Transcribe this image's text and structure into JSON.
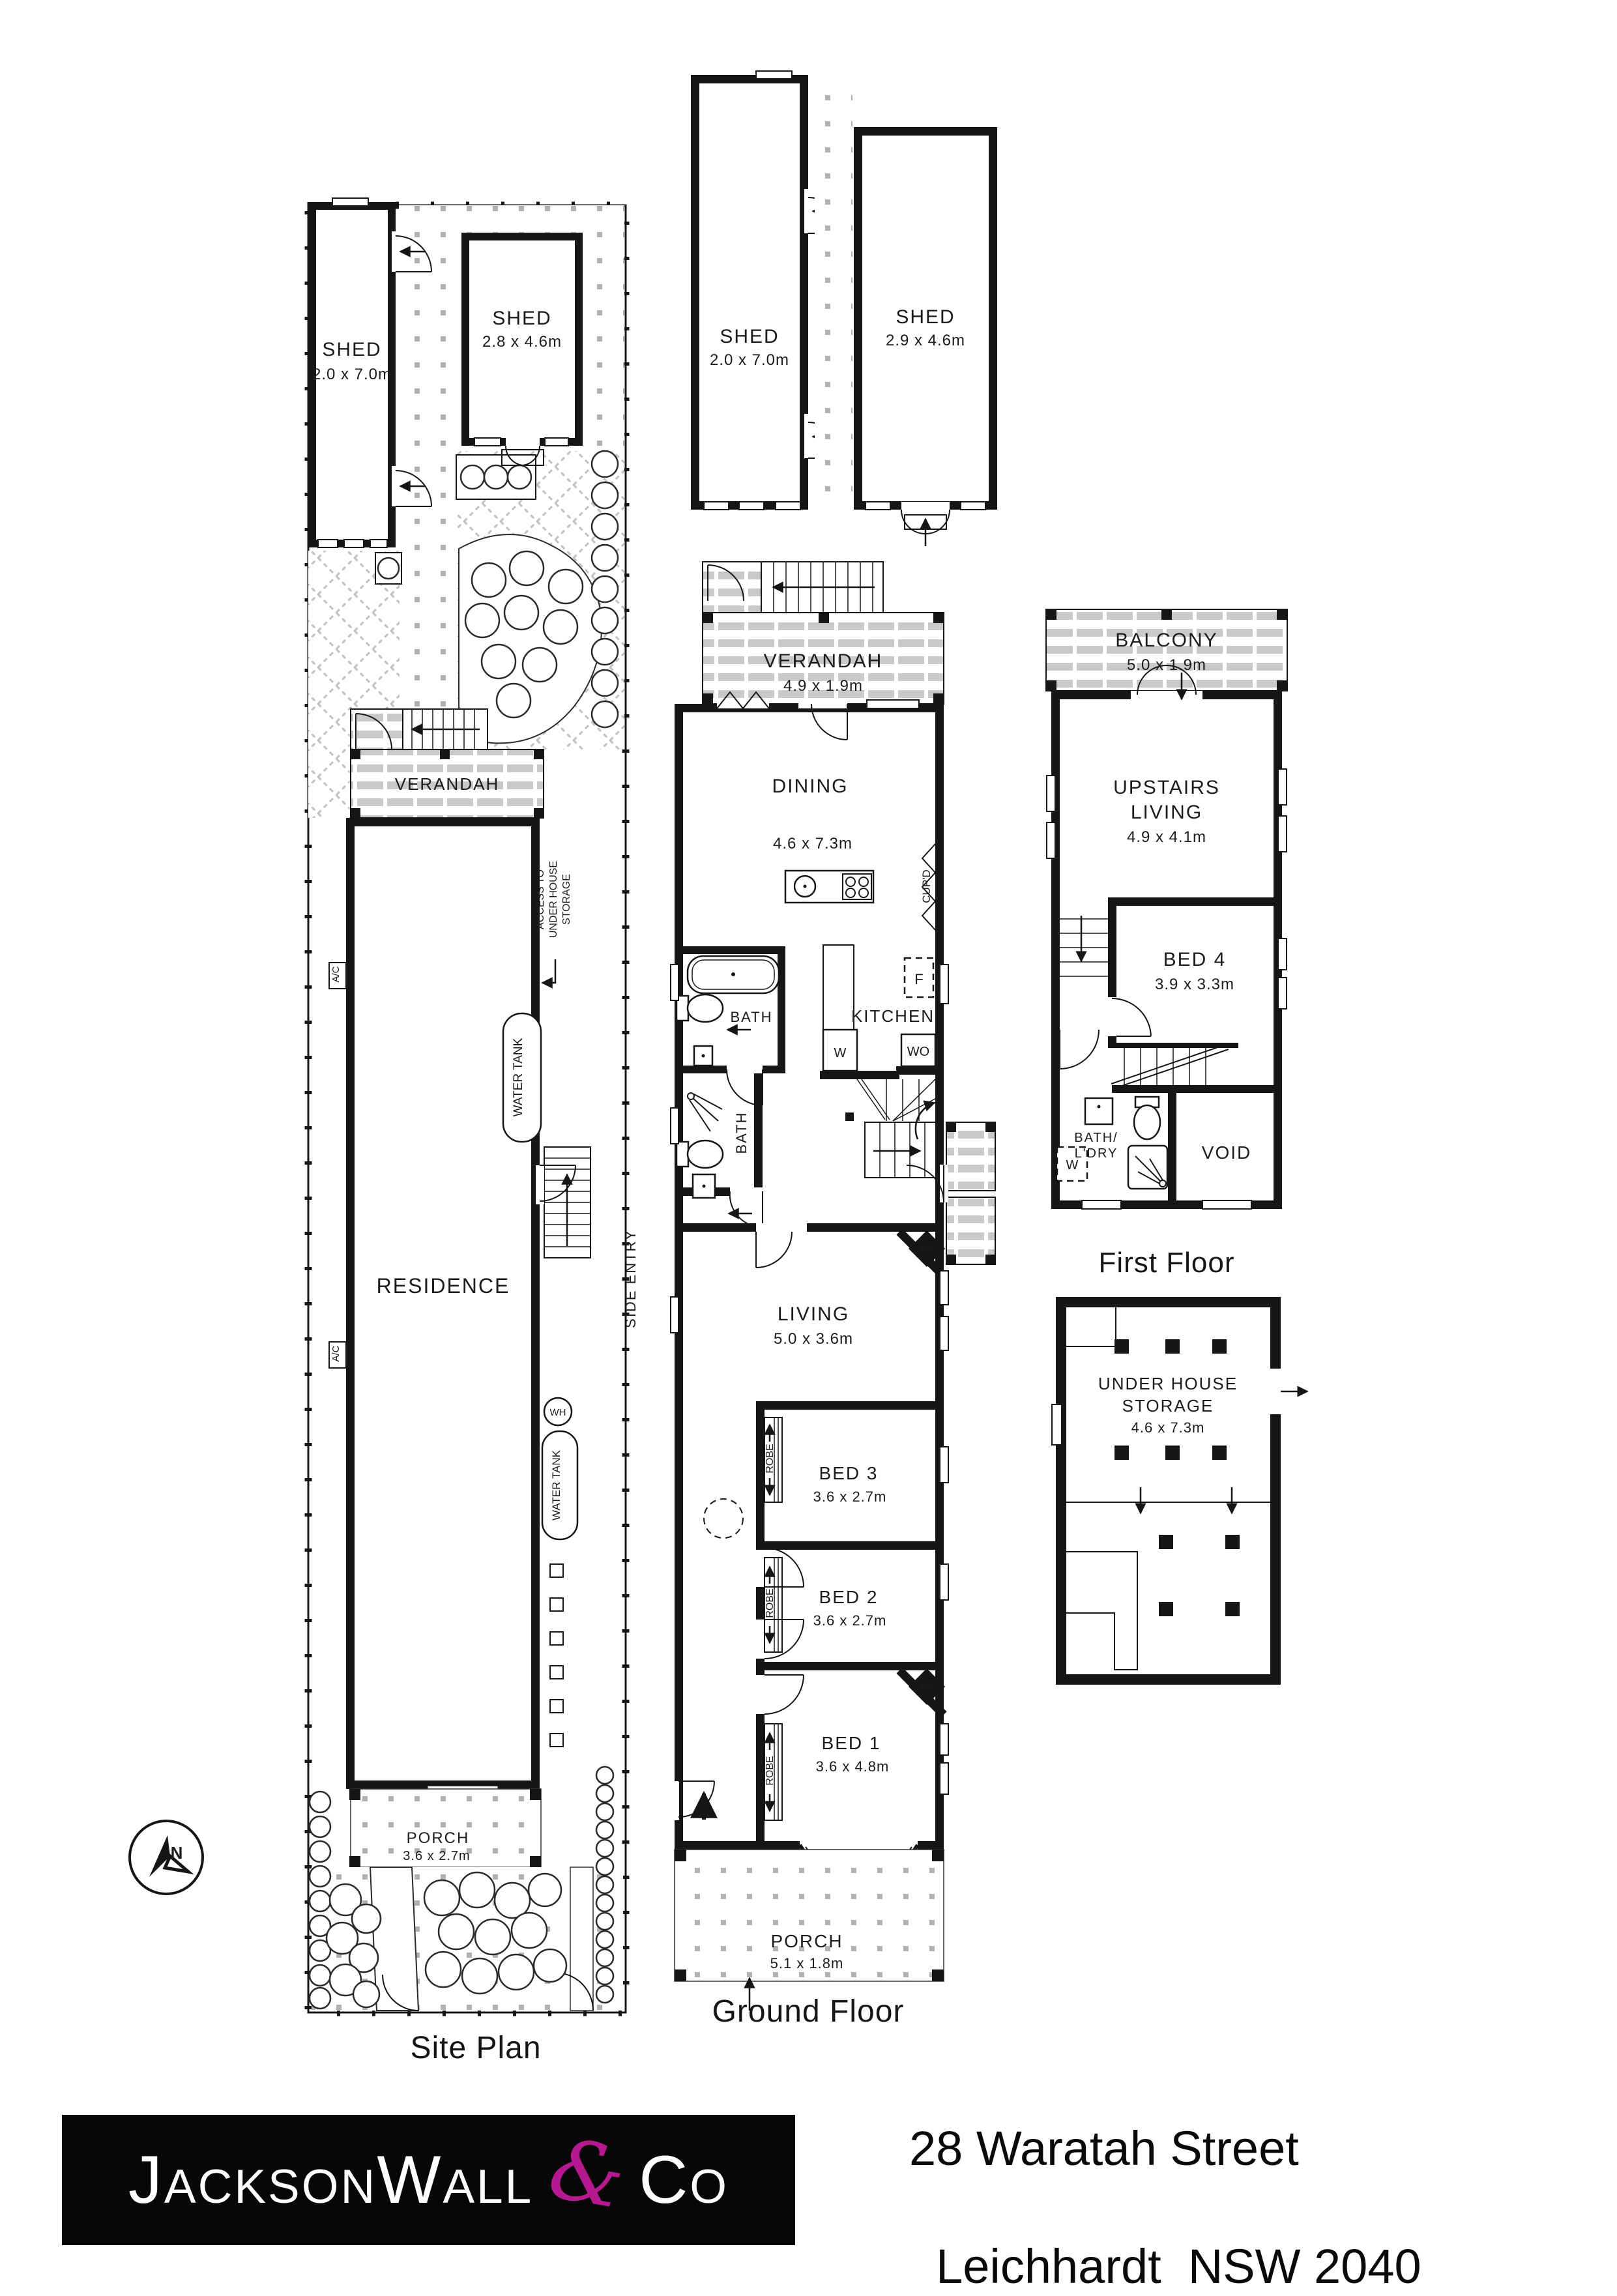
{
  "site_plan": {
    "label": "Site Plan",
    "shed_left": {
      "name": "SHED",
      "dims": "2.0 x 7.0m"
    },
    "shed_right": {
      "name": "SHED",
      "dims": "2.8 x 4.6m"
    },
    "verandah": {
      "name": "VERANDAH"
    },
    "residence": {
      "name": "RESIDENCE"
    },
    "porch": {
      "name": "PORCH",
      "dims": "3.6 x 2.7m"
    },
    "access_storage": {
      "line1": "ACCESS TO",
      "line2": "UNDER HOUSE",
      "line3": "STORAGE"
    },
    "water_tank": "WATER TANK",
    "ac_unit": "A/C",
    "water_heater": "WH",
    "side_entry": "SIDE ENTRY",
    "compass_north": "N"
  },
  "ground_floor": {
    "label": "Ground Floor",
    "shed_left": {
      "name": "SHED",
      "dims": "2.0 x 7.0m"
    },
    "shed_right": {
      "name": "SHED",
      "dims": "2.9 x 4.6m"
    },
    "verandah": {
      "name": "VERANDAH",
      "dims": "4.9 x 1.9m"
    },
    "dining": {
      "name": "DINING",
      "dims": "4.6 x 7.3m"
    },
    "cupboard": "CUP'D",
    "bath": "BATH",
    "kitchen": {
      "name": "KITCHEN",
      "fridge": "F",
      "washer": "W",
      "wall_oven": "WO"
    },
    "living": {
      "name": "LIVING",
      "dims": "5.0 x 3.6m"
    },
    "fireplace": "FP",
    "bed3": {
      "name": "BED 3",
      "dims": "3.6 x 2.7m"
    },
    "bed2": {
      "name": "BED 2",
      "dims": "3.6 x 2.7m"
    },
    "bed1": {
      "name": "BED 1",
      "dims": "3.6 x 4.8m"
    },
    "robe": "ROBE",
    "bench": "BENCH",
    "porch": {
      "name": "PORCH",
      "dims": "5.1 x 1.8m"
    }
  },
  "first_floor": {
    "label": "First Floor",
    "balcony": {
      "name": "BALCONY",
      "dims": "5.0 x 1.9m"
    },
    "upstairs_living": {
      "line1": "UPSTAIRS",
      "line2": "LIVING",
      "dims": "4.9 x 4.1m"
    },
    "bed4": {
      "name": "BED 4",
      "dims": "3.9 x 3.3m"
    },
    "bath_laundry": {
      "line1": "BATH/",
      "line2": "L'DRY",
      "washer": "W"
    },
    "void": "VOID"
  },
  "under_house": {
    "line1": "UNDER HOUSE",
    "line2": "STORAGE",
    "dims": "4.6 x 7.3m"
  },
  "footer": {
    "brand_part1": "Jackson",
    "brand_part2": "Wall",
    "brand_amp": "&",
    "brand_part3": "Co",
    "address_line1": "28 Waratah Street",
    "address_line2": "Leichhardt  NSW 2040",
    "brand_accent": "#b5188f",
    "brand_bg": "#070707"
  }
}
